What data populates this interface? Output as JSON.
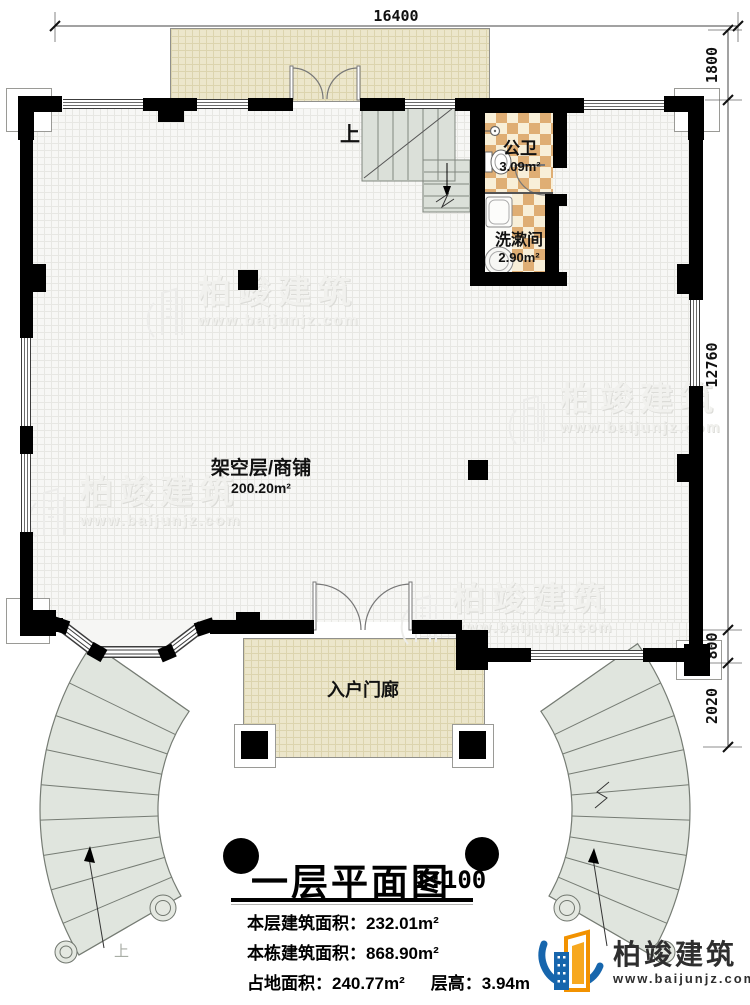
{
  "plan": {
    "dimensions": {
      "top": "16400",
      "right": [
        "1800",
        "12760",
        "800",
        "2020"
      ]
    },
    "rooms": {
      "shop": {
        "name": "架空层/商铺",
        "area": "200.20m²"
      },
      "toilet": {
        "name": "公卫",
        "area": "3.09m²"
      },
      "washroom": {
        "name": "洗漱间",
        "area": "2.90m²"
      },
      "porch": {
        "name": "入户门廊"
      }
    },
    "stair_up_label": "上"
  },
  "title_block": {
    "title": "一层平面图",
    "scale": "1:100",
    "lines": [
      "本层建筑面积：232.01m²",
      "本栋建筑面积：868.90m²"
    ],
    "site_area": "占地面积：240.77m²",
    "floor_height": "层高：3.94m"
  },
  "watermark": {
    "brand": "柏竣建筑",
    "url": "www.baijunjz.com"
  },
  "logo": {
    "brand": "柏竣建筑",
    "url": "www.baijunjz.com"
  },
  "colors": {
    "wall": "#000000",
    "terrace": "#ece6cb",
    "checker_tan": "#dfae74",
    "stair": "#dbe0d9",
    "logo_blue": "#1766ad",
    "logo_orange": "#f29200"
  }
}
